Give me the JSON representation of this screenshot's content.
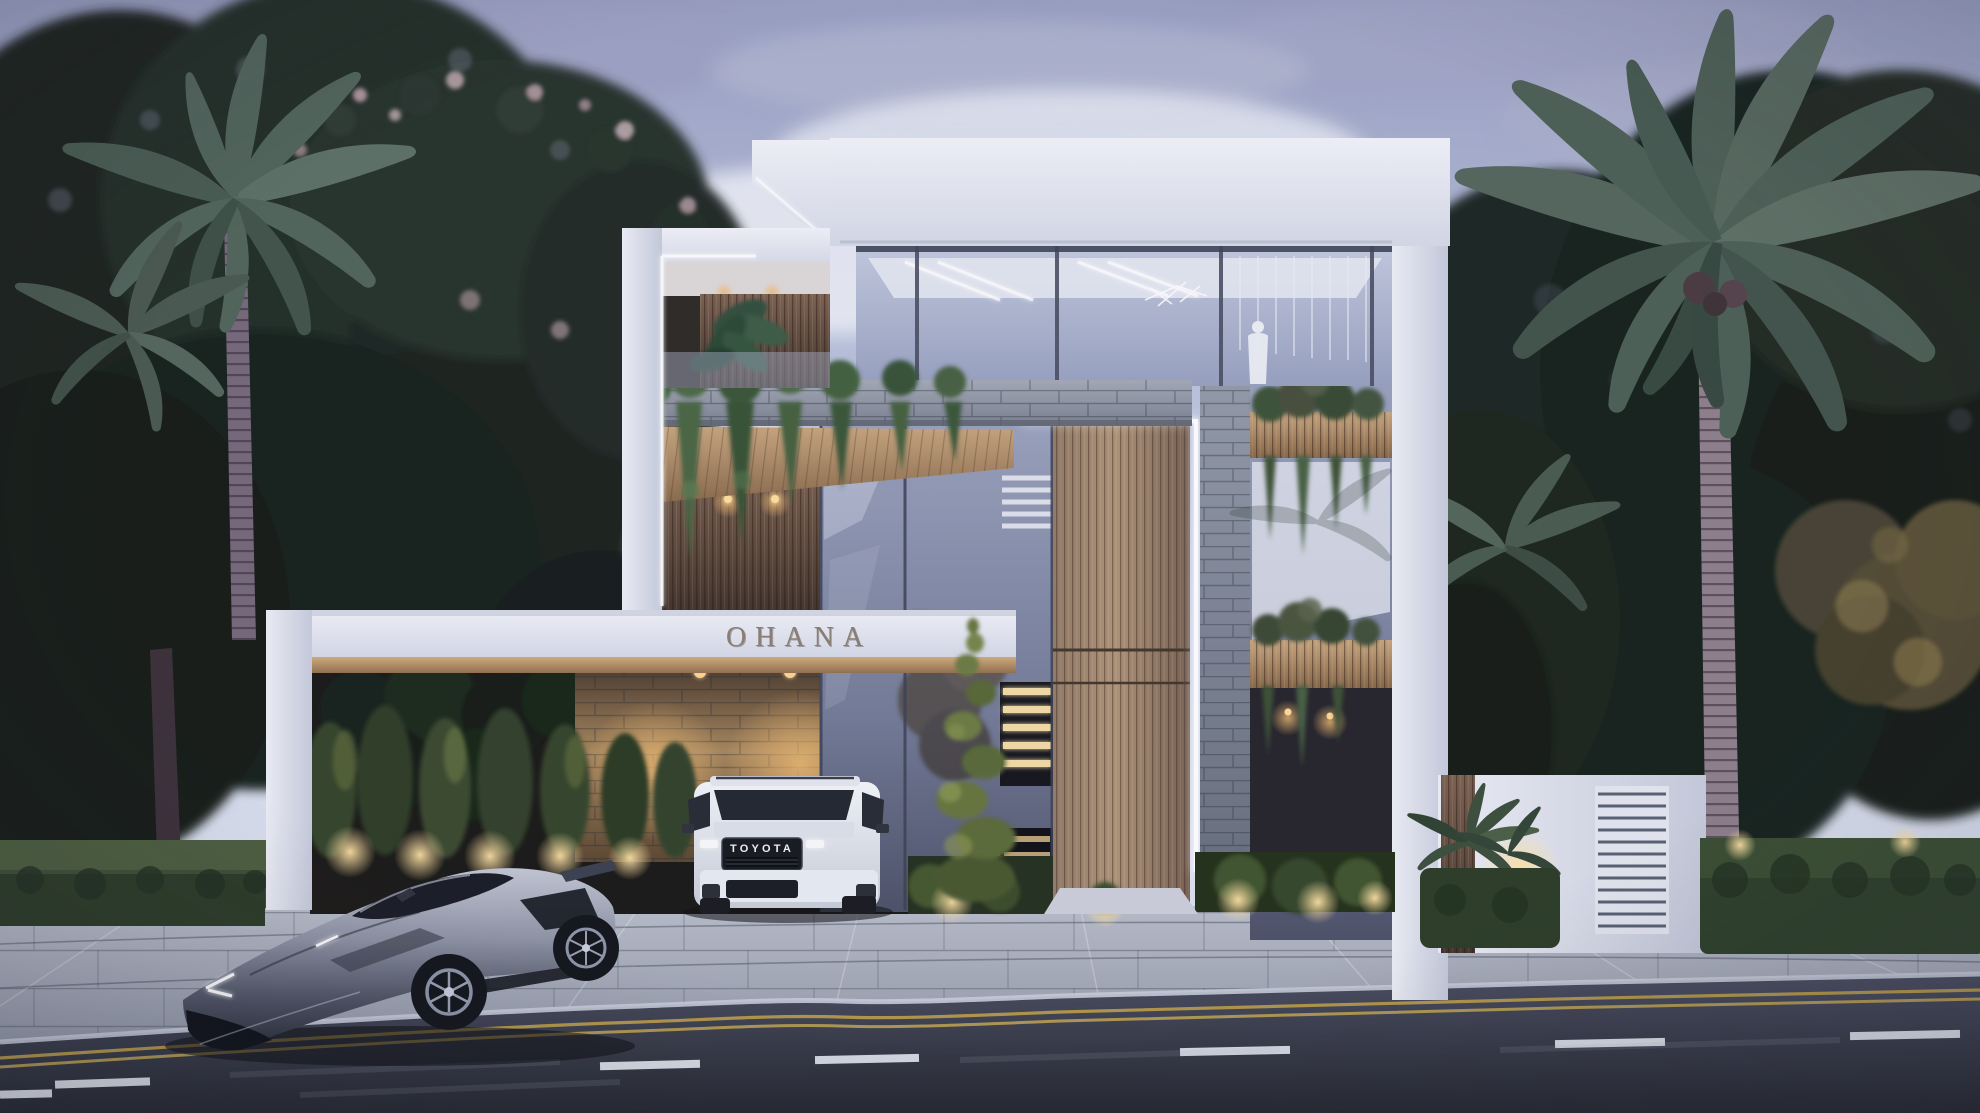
{
  "image": {
    "kind": "3D architectural exterior rendering",
    "setting": "Modern three-storey luxury villa at dusk, tropical landscaping, vehicles parked in front",
    "canvas": {
      "width": 1980,
      "height": 1113
    }
  },
  "signage": {
    "villa_name": "OHANA",
    "suv_badge": "TOYOTA"
  },
  "scene_objects": [
    "dusk sky with mauve clouds",
    "dense tropical tree backdrop",
    "flowering tree with pink blossoms",
    "tall palm trees left and right",
    "white villa with LED strip lighting",
    "rooftop glass lounge with standing figure in white robe",
    "grey stone accent band with hanging planters",
    "wood slat entry tower",
    "illuminated interior staircase",
    "spiral topiary at entrance",
    "OHANA fascia sign over carport",
    "carport with warm-lit stone feature wall",
    "white Toyota SUV parked in carport",
    "silver supercar in foreground",
    "white boundary wall with louver panel",
    "fan palm and hedges",
    "garden uplights",
    "paver driveway and apron",
    "asphalt road with double yellow line and white lane dashes"
  ],
  "palette": {
    "sky_top": "#9aa0c2",
    "sky_mid": "#c6cee4",
    "sky_bright": "#e2e7f2",
    "cloud_mauve": "#a7abc8",
    "sunset_pink": "#ecc9ba",
    "foliage_dark": "#1c2621",
    "foliage_mid": "#2e3d34",
    "palm_frond": "#5c7065",
    "hedge": "#32432b",
    "grass_lit": "#7d8a52",
    "building_white": "#e9ecf4",
    "building_shadow": "#cfd4e2",
    "led_white": "#ffffff",
    "glass": "#9aa3bf",
    "glass_dark": "#666d86",
    "wood_soffit": "#b5916c",
    "wood_slat": "#8d7560",
    "stone_band": "#8f95a1",
    "stone_warm": "#a8885c",
    "warm_light": "#f3cf8e",
    "stair_light": "#f0d9a4",
    "ohana_letters": "#8b7f74",
    "suv_white": "#eef1f7",
    "grille_black": "#17191f",
    "car_silver": "#9298a9",
    "paver": "#a9afbc",
    "road": "#32353f",
    "lane_yellow": "#bfa14c",
    "lane_white": "#e8ebf2"
  }
}
